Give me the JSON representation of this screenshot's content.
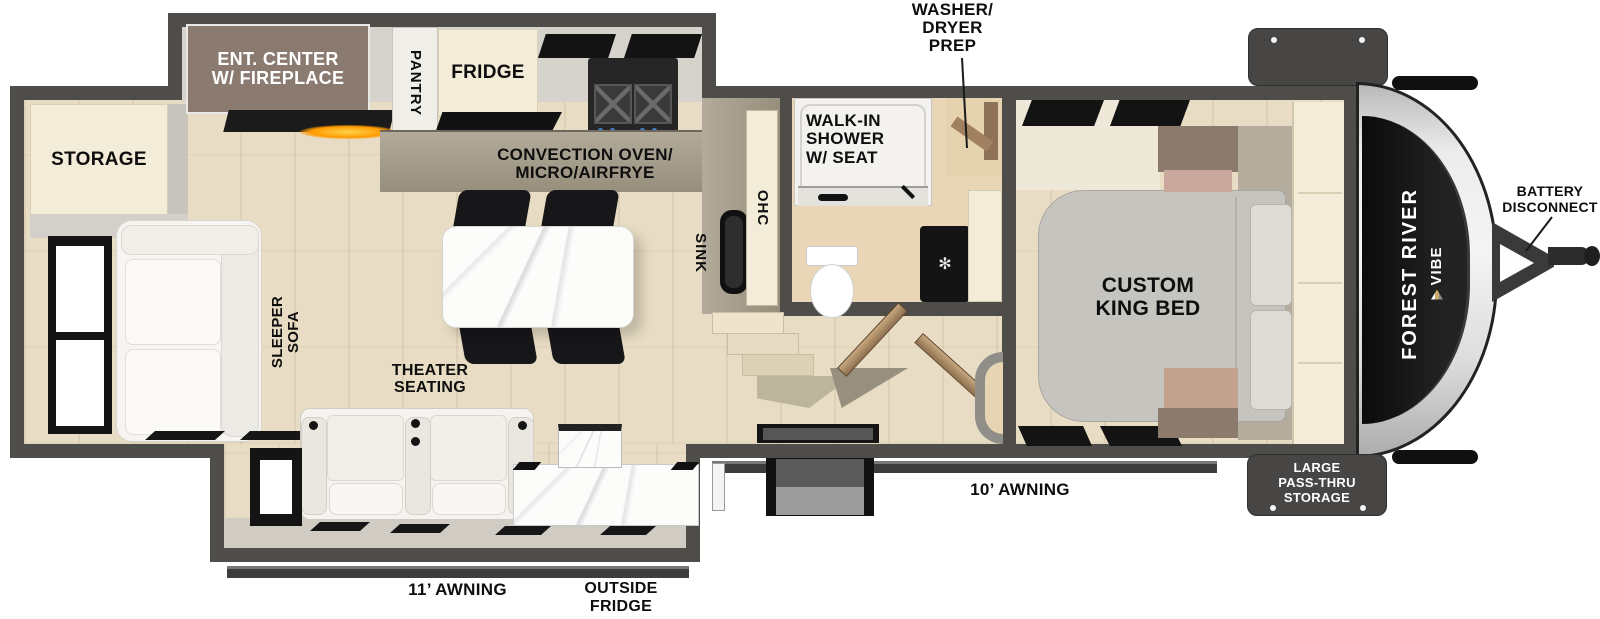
{
  "brand": {
    "line1": "FOREST RIVER",
    "line2": "VIBE"
  },
  "colors": {
    "wall": "#4f4d4a",
    "floor": "#e8ddc4",
    "cream_cabinet": "#f3ecd9",
    "ent_center_brown": "#8b7a6f",
    "flame_accent": "#ff9a00",
    "callout_box": "#474645"
  },
  "labels": {
    "storage": "STORAGE",
    "ent_center": [
      "ENT. CENTER",
      "W/ FIREPLACE"
    ],
    "pantry": "PANTRY",
    "fridge": "FRIDGE",
    "convection": [
      "CONVECTION OVEN/",
      "MICRO/AIRFRYE"
    ],
    "sink": "SINK",
    "ohc": "OHC",
    "washer_dryer_prep": [
      "WASHER/",
      "DRYER",
      "PREP"
    ],
    "walk_in_shower": [
      "WALK-IN",
      "SHOWER",
      "W/ SEAT"
    ],
    "custom_king_bed": [
      "CUSTOM",
      "KING BED"
    ],
    "battery_disconnect": [
      "BATTERY",
      "DISCONNECT"
    ],
    "sleeper_sofa": [
      "SLEEPER",
      "SOFA"
    ],
    "theater_seating": [
      "THEATER",
      "SEATING"
    ],
    "awning_door_side": "10’ AWNING",
    "awning_camp_side": "11’ AWNING",
    "outside_fridge": [
      "OUTSIDE",
      "FRIDGE"
    ],
    "pass_thru_storage": [
      "LARGE",
      "PASS-THRU",
      "STORAGE"
    ]
  }
}
